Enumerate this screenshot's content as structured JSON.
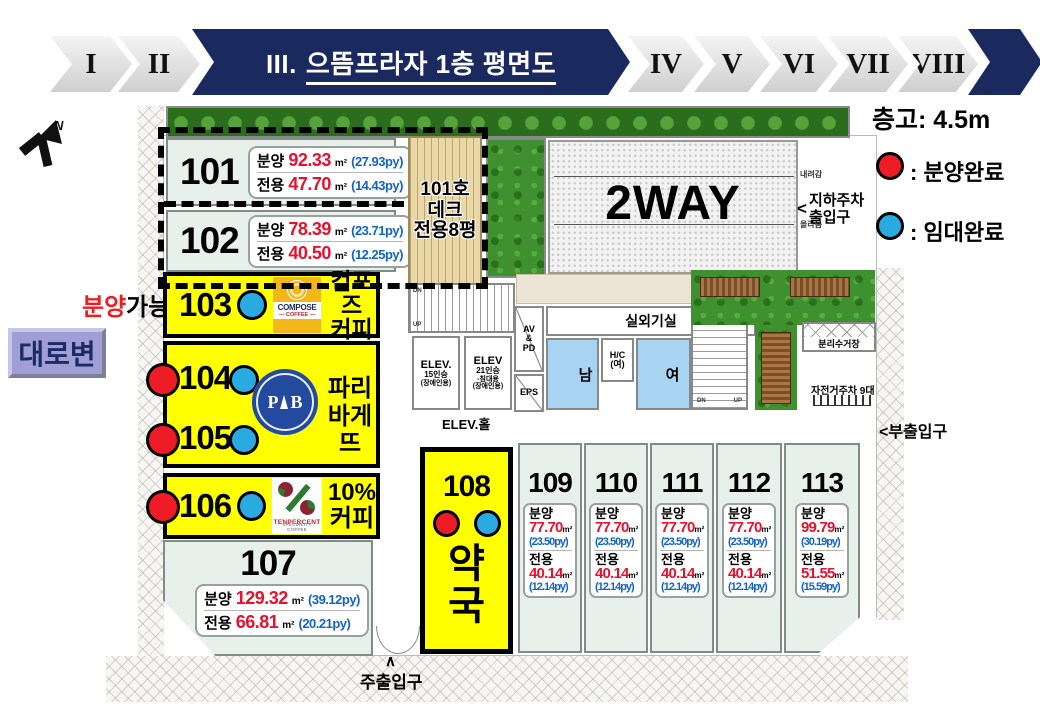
{
  "nav": {
    "prev": [
      "I",
      "II"
    ],
    "active_prefix": "III.",
    "active_title": "으뜸프라자 1층 평면도",
    "next": [
      "IV",
      "V",
      "VI",
      "VII",
      "VIII"
    ]
  },
  "legend": {
    "ceiling_label": "층고: 4.5m",
    "sold_label": ": 분양완료",
    "leased_label": ": 임대완료",
    "sold_color": "#ee1c25",
    "leased_color": "#29abe2",
    "unit_fill_color": "#ffff00",
    "room_fill_color": "#e7f0ea"
  },
  "side_labels": {
    "road": "대로변",
    "available_part1": "분양",
    "available_part2": "가능",
    "north": "N"
  },
  "units": {
    "u101": {
      "num": "101",
      "sale_label": "분양",
      "sale_value": "92.33",
      "sale_unit": "m²",
      "sale_py": "(27.93py)",
      "excl_label": "전용",
      "excl_value": "47.70",
      "excl_unit": "m²",
      "excl_py": "(14.43py)"
    },
    "u102": {
      "num": "102",
      "sale_label": "분양",
      "sale_value": "78.39",
      "sale_unit": "m²",
      "sale_py": "(23.71py)",
      "excl_label": "전용",
      "excl_value": "40.50",
      "excl_unit": "m²",
      "excl_py": "(12.25py)"
    },
    "u103": {
      "num": "103",
      "tenant1": "컴포즈",
      "tenant2": "커피"
    },
    "u104": {
      "num": "104"
    },
    "u105": {
      "num": "105"
    },
    "u104_105_tenant": {
      "line1": "파리",
      "line2": "바게뜨"
    },
    "u106": {
      "num": "106",
      "tenant1": "10%",
      "tenant2": "커피"
    },
    "u107": {
      "num": "107",
      "sale_label": "분양",
      "sale_value": "129.32",
      "sale_unit": "m²",
      "sale_py": "(39.12py)",
      "excl_label": "전용",
      "excl_value": "66.81",
      "excl_unit": "m²",
      "excl_py": "(20.21py)"
    },
    "u108": {
      "num": "108",
      "tenant1": "약",
      "tenant2": "국"
    },
    "u109": {
      "num": "109",
      "sale_label": "분양",
      "sale_value": "77.70",
      "sale_unit": "m²",
      "sale_py": "(23.50py)",
      "excl_label": "전용",
      "excl_value": "40.14",
      "excl_unit": "m²",
      "excl_py": "(12.14py)"
    },
    "u110": {
      "num": "110",
      "sale_label": "분양",
      "sale_value": "77.70",
      "sale_unit": "m²",
      "sale_py": "(23.50py)",
      "excl_label": "전용",
      "excl_value": "40.14",
      "excl_unit": "m²",
      "excl_py": "(12.14py)"
    },
    "u111": {
      "num": "111",
      "sale_label": "분양",
      "sale_value": "77.70",
      "sale_unit": "m²",
      "sale_py": "(23.50py)",
      "excl_label": "전용",
      "excl_value": "40.14",
      "excl_unit": "m²",
      "excl_py": "(12.14py)"
    },
    "u112": {
      "num": "112",
      "sale_label": "분양",
      "sale_value": "77.70",
      "sale_unit": "m²",
      "sale_py": "(23.50py)",
      "excl_label": "전용",
      "excl_value": "40.14",
      "excl_unit": "m²",
      "excl_py": "(12.14py)"
    },
    "u113": {
      "num": "113",
      "sale_label": "분양",
      "sale_value": "99.79",
      "sale_unit": "m²",
      "sale_py": "(30.19py)",
      "excl_label": "전용",
      "excl_value": "51.55",
      "excl_unit": "m²",
      "excl_py": "(15.59py)"
    }
  },
  "logos": {
    "compose": {
      "name": "COMPOSE",
      "sub": "— COFFEE —"
    },
    "paris_baguette": {
      "left": "P",
      "right": "B"
    },
    "ten_percent": {
      "name": "TENPERCENT",
      "sub": "SPECIALITY COFFEE"
    }
  },
  "facilities": {
    "two_way": "2WAY",
    "deck_line1": "101호",
    "deck_line2": "데크",
    "deck_line3": "전용8평",
    "outdoor_unit": "실외기실",
    "elev_hall": "ELEV.홀",
    "elev1_line1": "ELEV.",
    "elev1_line2": "15인승",
    "elev1_line3": "(장애인용)",
    "elev2_line1": "ELEV",
    "elev2_line2": "21인승",
    "elev2_line3": "-침대용",
    "elev2_line4": "(장애인용)",
    "av1": "AV",
    "av2": "&",
    "av3": "PD",
    "eps": "EPS",
    "men": "남",
    "women": "여",
    "hc_line1": "H/C",
    "hc_line2": "(여)",
    "recycle": "분리수거장",
    "bike": "자전거주차 9대",
    "side_entrance": "부출입구",
    "side_entrance_arrow": "<",
    "main_entrance": "주출입구",
    "main_entrance_arrow": "∧",
    "underground_line1": "지하주차",
    "underground_line2": "출입구",
    "underground_arrow": "<",
    "ramp_down": "내려감",
    "ramp_up": "올라옴",
    "dn": "DN",
    "up": "UP"
  }
}
